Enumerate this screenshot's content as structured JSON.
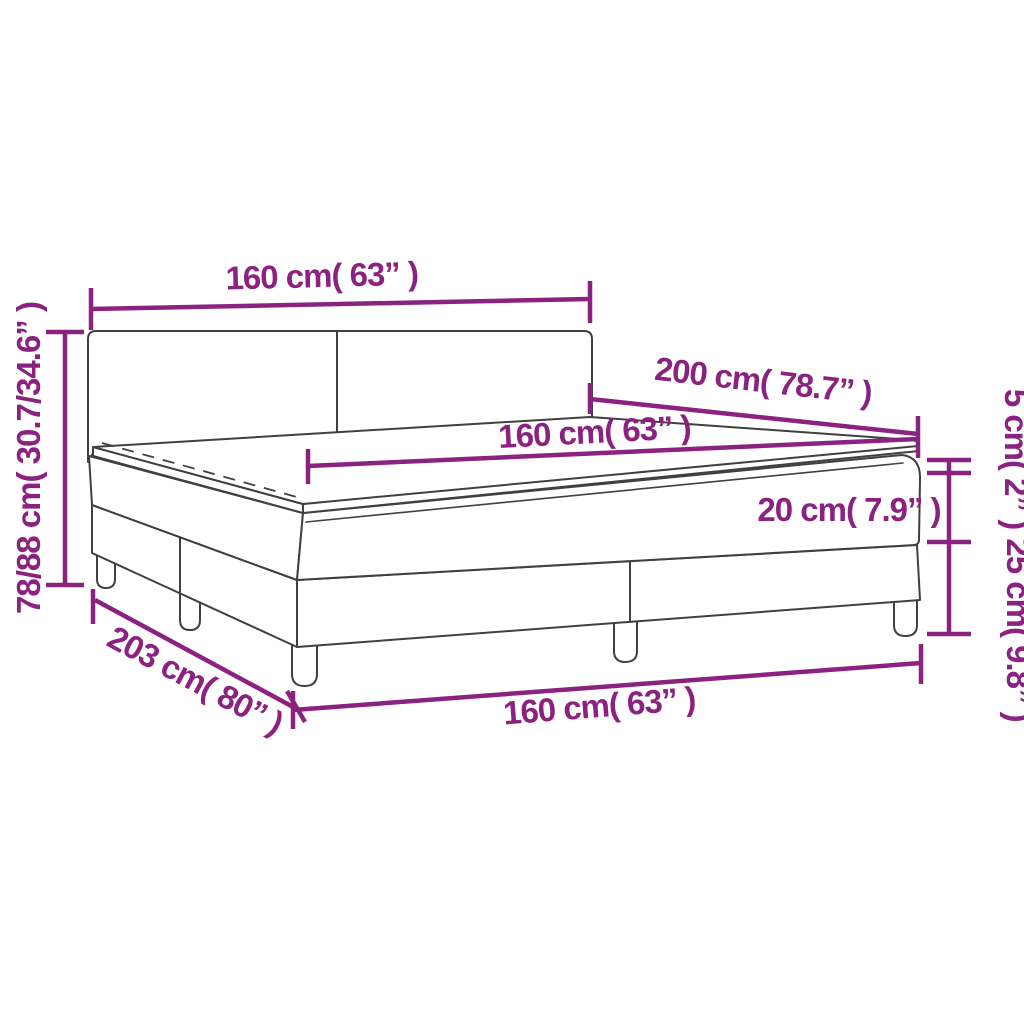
{
  "diagram": {
    "kind": "product-dimension-diagram",
    "colors": {
      "dimension_accent": "#8b2280",
      "outline": "#404040",
      "background": "#ffffff"
    },
    "labels": {
      "width_top": "160 cm( 63” )",
      "total_height": "78/88 cm( 30.7/34.6” )",
      "length": "200 cm( 78.7” )",
      "mattress_width": "160 cm( 63” )",
      "mattress_thickness": "20 cm( 7.9” )",
      "topper_thickness": "5 cm( 2” )",
      "base_height": "25 cm( 9.8” )",
      "total_length": "203 cm( 80” )",
      "width_bottom": "160 cm( 63” )"
    }
  }
}
